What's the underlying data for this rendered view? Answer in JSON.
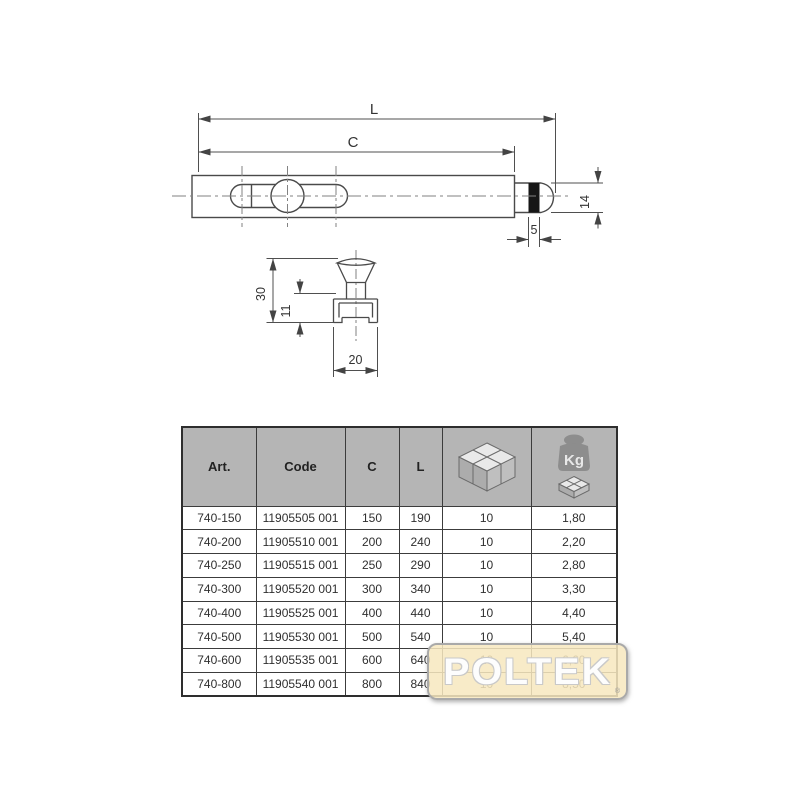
{
  "drawing": {
    "labels": {
      "length_total": "L",
      "length_c": "C",
      "diameter": "14",
      "band_width": "5",
      "clip_height_total": "30",
      "channel_height": "11",
      "channel_width": "20"
    }
  },
  "table": {
    "headers": {
      "art": "Art.",
      "code": "Code",
      "c": "C",
      "l": "L",
      "box_icon": "carton-box-icon",
      "weight_icon": "weight-kg-icon",
      "kg_label": "Kg"
    },
    "rows": [
      {
        "art": "740-150",
        "code": "11905505 001",
        "c": "150",
        "l": "190",
        "qty": "10",
        "kg": "1,80"
      },
      {
        "art": "740-200",
        "code": "11905510 001",
        "c": "200",
        "l": "240",
        "qty": "10",
        "kg": "2,20"
      },
      {
        "art": "740-250",
        "code": "11905515 001",
        "c": "250",
        "l": "290",
        "qty": "10",
        "kg": "2,80"
      },
      {
        "art": "740-300",
        "code": "11905520 001",
        "c": "300",
        "l": "340",
        "qty": "10",
        "kg": "3,30"
      },
      {
        "art": "740-400",
        "code": "11905525 001",
        "c": "400",
        "l": "440",
        "qty": "10",
        "kg": "4,40"
      },
      {
        "art": "740-500",
        "code": "11905530 001",
        "c": "500",
        "l": "540",
        "qty": "10",
        "kg": "5,40"
      },
      {
        "art": "740-600",
        "code": "11905535 001",
        "c": "600",
        "l": "640",
        "qty": "10",
        "kg": "6,60"
      },
      {
        "art": "740-800",
        "code": "11905540 001",
        "c": "800",
        "l": "840",
        "qty": "10",
        "kg": "8,50"
      }
    ]
  },
  "watermark": {
    "text": "POLTEK",
    "registered_mark": "®"
  },
  "colors": {
    "header_bg": "#b5b5b5",
    "table_border": "#3c3c3c",
    "drawing_line": "#4a4a4a",
    "band_fill": "#161616",
    "watermark_bg": "#f7e8bf",
    "watermark_border": "#a9a9a9",
    "watermark_text": "#fdfdfd",
    "weight_icon_fill": "#8d8d8d"
  }
}
